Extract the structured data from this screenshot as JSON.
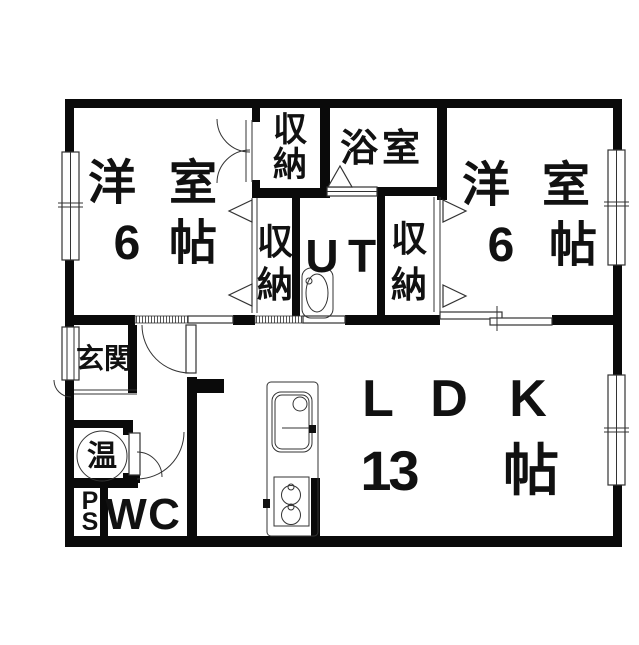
{
  "plan": {
    "title": "apartment-floor-plan",
    "rooms": {
      "bedroom_left": {
        "name": "洋室",
        "size": "6帖"
      },
      "bedroom_right": {
        "name": "洋室",
        "size": "6帖"
      },
      "ldk": {
        "name": "LDK",
        "size": "13帖"
      },
      "bathroom": {
        "name": "浴室"
      },
      "utility": {
        "name": "UT"
      },
      "closet_top": {
        "name": "収納"
      },
      "closet_mid_left": {
        "name": "収納"
      },
      "closet_mid_right": {
        "name": "収納"
      },
      "entrance": {
        "name": "玄関"
      },
      "water_heater": {
        "name": "温"
      },
      "pipe_space": {
        "name": "PS"
      },
      "wc": {
        "name": "WC"
      }
    },
    "colors": {
      "wall": "#0a0a0a",
      "line": "#333333",
      "background": "#ffffff",
      "text": "#111111"
    }
  }
}
